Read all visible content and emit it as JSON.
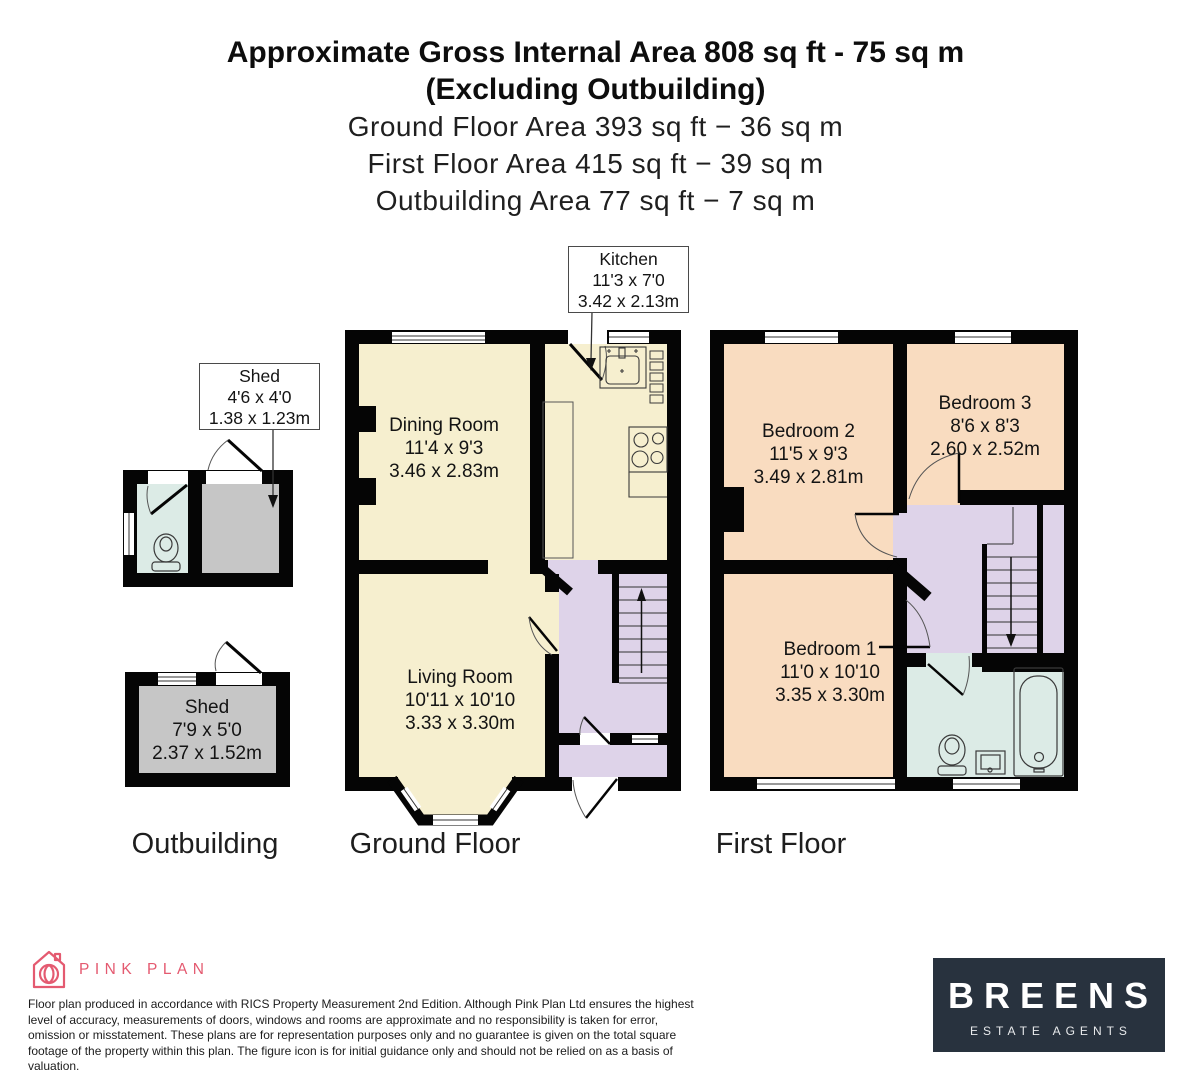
{
  "header": {
    "line1": "Approximate Gross Internal Area 808 sq ft - 75 sq m",
    "line2": "(Excluding Outbuilding)",
    "line3": "Ground Floor Area 393 sq ft − 36 sq m",
    "line4": "First Floor Area 415 sq ft − 39 sq m",
    "line5": "Outbuilding Area 77 sq ft − 7 sq m"
  },
  "labels": {
    "kitchen": {
      "name": "Kitchen",
      "imperial": "11'3 x 7'0",
      "metric": "3.42 x 2.13m"
    },
    "shed_small": {
      "name": "Shed",
      "imperial": "4'6 x 4'0",
      "metric": "1.38 x 1.23m"
    },
    "shed_large": {
      "name": "Shed",
      "imperial": "7'9 x 5'0",
      "metric": "2.37 x 1.52m"
    },
    "dining": {
      "name": "Dining Room",
      "imperial": "11'4 x 9'3",
      "metric": "3.46 x 2.83m"
    },
    "living": {
      "name": "Living Room",
      "imperial": "10'11 x 10'10",
      "metric": "3.33 x 3.30m"
    },
    "bedroom1": {
      "name": "Bedroom 1",
      "imperial": "11'0 x 10'10",
      "metric": "3.35 x 3.30m"
    },
    "bedroom2": {
      "name": "Bedroom 2",
      "imperial": "11'5 x 9'3",
      "metric": "3.49 x 2.81m"
    },
    "bedroom3": {
      "name": "Bedroom 3",
      "imperial": "8'6 x 8'3",
      "metric": "2.60 x 2.52m"
    }
  },
  "captions": {
    "outbuilding": "Outbuilding",
    "ground": "Ground Floor",
    "first": "First Floor"
  },
  "footer": {
    "brand": "PINK PLAN",
    "disclaimer": "Floor plan produced in accordance with RICS Property Measurement 2nd Edition. Although Pink Plan Ltd ensures the highest level of accuracy, measurements of doors, windows and rooms are approximate and no responsibility is taken for error, omission or misstatement. These plans are for representation purposes only and no guarantee is given on the total square footage of the property within this plan. The figure icon is for initial guidance only and should not be relied on as a basis of valuation.",
    "agent_name": "BREENS",
    "agent_sub": "ESTATE AGENTS"
  },
  "colors": {
    "walls": "#050505",
    "ground_floor_room": "#f6efcf",
    "hallway": "#ded3e9",
    "first_floor_room": "#f9dcc0",
    "bathroom": "#dcebe6",
    "shed": "#c6c6c6",
    "brand_pink": "#e45a70",
    "agent_box_bg": "#28323e"
  }
}
